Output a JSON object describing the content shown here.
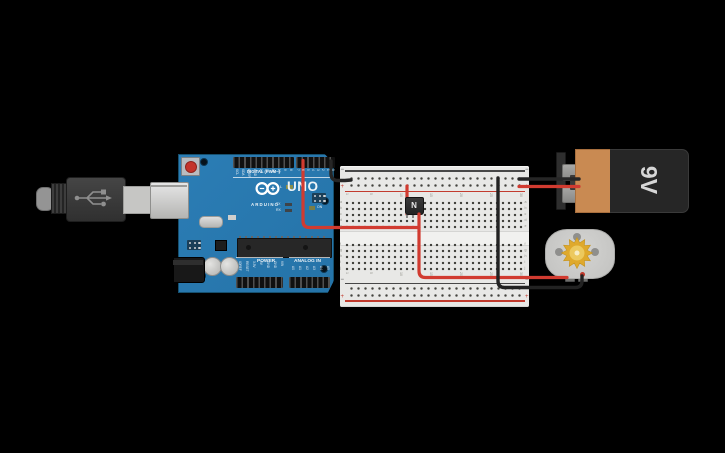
{
  "scene": {
    "background": "#000000"
  },
  "colors": {
    "board_blue": "#2878b0",
    "wire_red": "#d13b30",
    "wire_black": "#262626",
    "battery_orange": "#c98a52",
    "battery_black": "#262626",
    "motor_gray": "#c6c6c4",
    "gear_yellow": "#dfa92c",
    "breadboard": "#e8e8e6",
    "rail_red_line": "#c23b2e",
    "rail_black_line": "#474747"
  },
  "arduino": {
    "digital_label": "DIGITAL (PWM~)",
    "logo_text": "ARDUINO",
    "model": "UNO",
    "power_label": "POWER",
    "analog_label": "ANALOG IN",
    "led_l": "L",
    "led_tx": "TX",
    "led_rx": "RX",
    "led_on": "ON",
    "digital_pins_left": [
      "SCL",
      "SDA",
      "AREF",
      "GND",
      "13",
      "12",
      "11",
      "10",
      "9",
      "8"
    ],
    "digital_pins_right": [
      "7",
      "6",
      "5",
      "4",
      "3",
      "2",
      "1",
      "0"
    ],
    "power_pins": [
      "IOREF",
      "RESET",
      "3.3V",
      "5V",
      "GND",
      "GND",
      "VIN"
    ],
    "analog_pins": [
      "A0",
      "A1",
      "A2",
      "A3",
      "A4",
      "A5"
    ]
  },
  "breadboard": {
    "plus": "+",
    "minus": "−",
    "column_numbers": [
      "1",
      "5",
      "10",
      "15",
      "20",
      "25",
      "30"
    ],
    "row_letters_top": [
      "a",
      "b",
      "c",
      "d",
      "e"
    ],
    "row_letters_bottom": [
      "f",
      "g",
      "h",
      "i",
      "j"
    ]
  },
  "transistor": {
    "label": "N"
  },
  "battery": {
    "label": "9V"
  }
}
